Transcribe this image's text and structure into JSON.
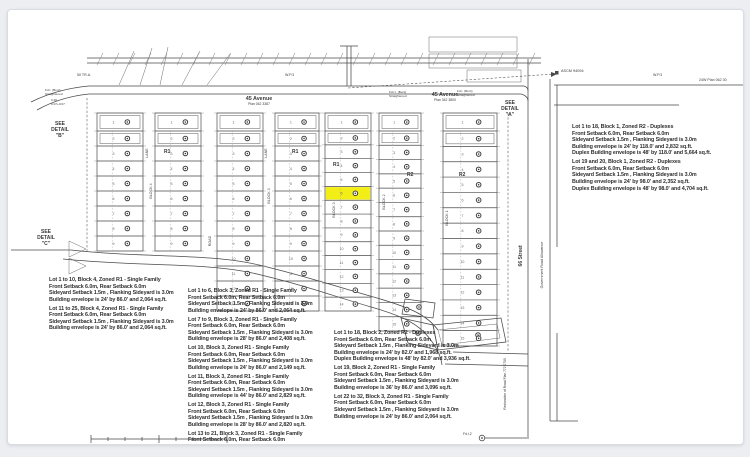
{
  "colors": {
    "page_bg": "#eceef2",
    "sheet_bg": "#ffffff",
    "ink": "#4a4a4a",
    "tick": "#9aa0a6",
    "lot_number": "#6a6a6a",
    "highlight": "#f3ee15"
  },
  "street_labels": {
    "avenue_left_name": "45 Avenue",
    "avenue_left_plan": "Plan 042 3387",
    "avenue_right_name": "45 Avenue",
    "avenue_right_plan": "Plan 342 3800",
    "street_66": "66 Street",
    "gov_road_allowance": "Government Road Allowance",
    "road_restoration": "Restoration of Road Plan 772 2759",
    "trail_left": "50 TR.A.",
    "wp3_left": "W.P.3",
    "wp3_right": "W.P.3",
    "plan_top_right": "24W Plan 062 30"
  },
  "detail_labels": {
    "a": "SEE\nDETAIL\n\"A\"",
    "b": "SEE\nDETAIL\n\"B\"",
    "c": "SEE\nDETAIL\n\"C\""
  },
  "survey_marks": {
    "ascm": "ASCM 94094",
    "fd1": "Fd.I. (Bent)\nStraightened",
    "fd1_offset": "0.30\n0.07+0.07",
    "fd2": "Fd.I.I. (Bent)\nStraightened",
    "fd3": "Fd.I. (Bent)\nStraightened",
    "fd_bottom": "Fd.I.2"
  },
  "map": {
    "strips": [
      {
        "name": "block4-west",
        "x": 96,
        "w": 46,
        "top": 112,
        "bottom": 250,
        "rows": 9,
        "highlight": -1
      },
      {
        "name": "block4-east",
        "x": 154,
        "w": 46,
        "top": 112,
        "bottom": 250,
        "rows": 9,
        "highlight": -1
      },
      {
        "name": "block3-col1",
        "x": 216,
        "w": 46,
        "top": 112,
        "bottom": 310,
        "rows": 13,
        "highlight": -1
      },
      {
        "name": "block3-col2",
        "x": 274,
        "w": 44,
        "top": 112,
        "bottom": 310,
        "rows": 13,
        "highlight": -1
      },
      {
        "name": "block3-col3",
        "x": 324,
        "w": 46,
        "top": 112,
        "bottom": 310,
        "rows": 14,
        "highlight": 5
      },
      {
        "name": "block2",
        "x": 378,
        "w": 42,
        "top": 112,
        "bottom": 330,
        "rows": 15,
        "highlight": -1
      },
      {
        "name": "block1",
        "x": 442,
        "w": 54,
        "top": 112,
        "bottom": 345,
        "rows": 15,
        "highlight": -1
      }
    ],
    "zone_labels": [
      {
        "text": "R1",
        "x": 163,
        "y": 152
      },
      {
        "text": "R1",
        "x": 291,
        "y": 152
      },
      {
        "text": "R1",
        "x": 332,
        "y": 165
      },
      {
        "text": "R2",
        "x": 406,
        "y": 175
      },
      {
        "text": "R2",
        "x": 458,
        "y": 175
      }
    ],
    "vertical_labels": [
      {
        "text": "BLOCK 4",
        "x": 151,
        "y": 190
      },
      {
        "text": "BLOCK 3",
        "x": 269,
        "y": 195
      },
      {
        "text": "BLOCK 3",
        "x": 334,
        "y": 209
      },
      {
        "text": "BLOCK 2",
        "x": 384,
        "y": 201
      },
      {
        "text": "BLOCK 1",
        "x": 447,
        "y": 217
      },
      {
        "text": "LANE",
        "x": 147,
        "y": 152
      },
      {
        "text": "LANE",
        "x": 266,
        "y": 152
      },
      {
        "text": "ROAD",
        "x": 210,
        "y": 240
      }
    ]
  },
  "notes": {
    "left": [
      "Lot 1 to 10, Block 4, Zoned R1 - Single Family\nFront Setback 6.0m, Rear Setback 6.0m\nSideyard Setback 1.5m , Flanking Sideyard is 3.0m\nBuilding envelope is 24' by 86.0' and 2,064 sq.ft.",
      "Lot 11 to 25, Block 4, Zoned R1 - Single Family\nFront Setback 6.0m, Rear Setback 6.0m\nSideyard Setback 1.5m , Flanking Sideyard is 3.0m\nBuilding envelope is 24' by 86.0' and 2,064 sq.ft."
    ],
    "center": [
      "Lot 1 to 6, Block 3, Zoned R1 - Single Family\nFront Setback 6.0m, Rear Setback 6.0m\nSideyard Setback 1.5m , Flanking Sideyard is 3.0m\nBuilding envelope is 24' by 86.0' and 2,064 sq.ft.",
      "Lot 7 to 9, Block 3, Zoned R1 - Single Family\nFront Setback 6.0m, Rear Setback 6.0m\nSideyard Setback 1.5m , Flanking Sideyard is 3.0m\nBuilding envelope is 28' by 86.0' and 2,408 sq.ft.",
      "Lot 10, Block 3, Zoned R1 - Single Family\nFront Setback 6.0m, Rear Setback 6.0m\nSideyard Setback 1.5m , Flanking Sideyard is 3.0m\nBuilding envelope is 24' by 86.0' and 2,149 sq.ft.",
      "Lot 11, Block 3, Zoned R1 - Single Family\nFront Setback 6.0m, Rear Setback 6.0m\nSideyard Setback 1.5m , Flanking Sideyard is 3.0m\nBuilding envelope is 44' by 86.0' and 2,829 sq.ft.",
      "Lot 12, Block 3, Zoned R1 - Single Family\nFront Setback 6.0m, Rear Setback 6.0m\nSideyard Setback 1.5m , Flanking Sideyard is 3.0m\nBuilding envelope is 28' by 86.0' and 2,820 sq.ft.",
      "Lot 13 to 21, Block 3, Zoned R1 - Single Family\nFront Setback 6.0m, Rear Setback 6.0m\nSideyard Setback 1.5m , Flanking Sideyard is 3.0m"
    ],
    "right_bottom": [
      "Lot 1 to 18, Block 2, Zoned R2 - Duplexes\nFront Setback 6.0m, Rear Setback 6.0m\nSideyard Setback 1.5m , Flanking Sideyard is 3.0m\nBuilding envelope is 24' by 82.0' and 1,968 sq.ft.\nDuplex Building envelope is 48' by 82.0' and 3,936 sq.ft.",
      "Lot 19, Block 2, Zoned R1 - Single Family\nFront Setback 6.0m, Rear Setback 6.0m\nSideyard Setback 1.5m , Flanking Sideyard is 3.0m\nBuilding envelope is 36' by 86.0' and 3,096 sq.ft.",
      "Lot 22 to 32, Block 3, Zoned R1 - Single Family\nFront Setback 6.0m, Rear Setback 6.0m\nSideyard Setback 1.5m , Flanking Sideyard is 3.0m\nBuilding envelope is 24' by 86.0' and 2,064 sq.ft."
    ],
    "right_top": [
      "Lot 1 to 18, Block 1, Zoned R2 - Duplexes\nFront Setback 6.0m, Rear Setback 6.0m\nSideyard Setback 1.5m , Flanking Sideyard is 3.0m\nBuilding envelope is 24' by 118.0' and 2,832 sq.ft.\nDuplex Building envelope is 48' by 118.0' and 5,664 sq.ft.",
      "Lot 19 and 20, Block 1, Zoned R2 - Duplexes\nFront Setback 6.0m, Rear Setback 6.0m\nSideyard Setback 1.5m , Flanking Sideyard is 3.0m\nBuilding envelope is 24' by 98.0' and 2,352 sq.ft.\nDuplex Building envelope is 48' by 98.0' and 4,704 sq.ft."
    ]
  }
}
